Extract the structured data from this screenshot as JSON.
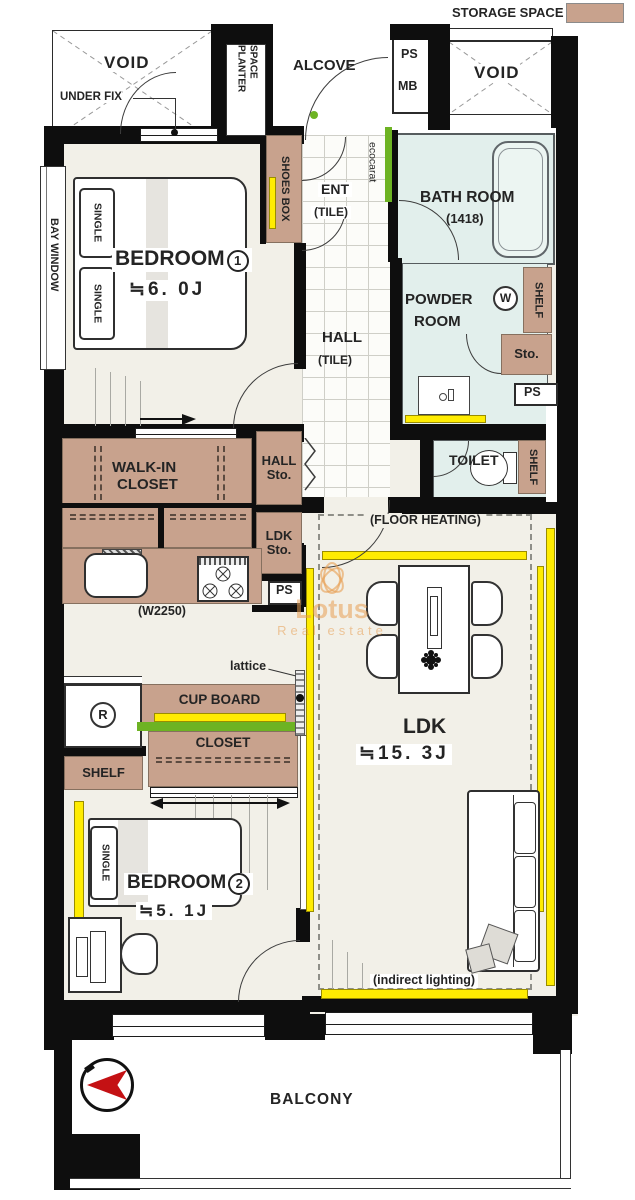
{
  "legend": {
    "storage_space": "STORAGE SPACE"
  },
  "top": {
    "void_left": "VOID",
    "under_fix": "UNDER FIX",
    "planter_1": "PLANTER",
    "planter_2": "SPACE",
    "alcove": "ALCOVE",
    "ps": "PS",
    "mb": "MB",
    "void_right": "VOID"
  },
  "entrance": {
    "shoes_box": "SHOES BOX",
    "ent": "ENT",
    "tile": "(TILE)",
    "ecocarat": "ecocarat"
  },
  "bath": {
    "name": "BATH ROOM",
    "size": "(1418)"
  },
  "powder": {
    "name_1": "POWDER",
    "name_2": "ROOM",
    "washer": "W",
    "shelf": "SHELF",
    "sto": "Sto.",
    "ps": "PS"
  },
  "toilet": {
    "name": "TOILET",
    "shelf": "SHELF"
  },
  "hall": {
    "name": "HALL",
    "tile": "(TILE)",
    "sto_1": "HALL",
    "sto_2": "Sto."
  },
  "bedroom1": {
    "name": "BEDROOM",
    "num": "1",
    "size": "≒6. 0J",
    "single": "SINGLE",
    "bay_window": "BAY WINDOW"
  },
  "wic": {
    "name_1": "WALK-IN",
    "name_2": "CLOSET"
  },
  "kitchen": {
    "width": "(W2250)",
    "ps": "PS",
    "ldk_sto_1": "LDK",
    "ldk_sto_2": "Sto.",
    "cup_board": "CUP BOARD",
    "closet": "CLOSET",
    "shelf": "SHELF",
    "fridge": "R",
    "lattice": "lattice"
  },
  "ldk": {
    "floor_heating": "(FLOOR HEATING)",
    "name": "LDK",
    "size": "≒15. 3J",
    "indirect": "(indirect lighting)"
  },
  "bedroom2": {
    "name": "BEDROOM",
    "num": "2",
    "size": "≒5. 1J",
    "single": "SINGLE"
  },
  "balcony": {
    "name": "BALCONY"
  },
  "watermark": {
    "line1": "Lotus",
    "line2": "Real estate"
  },
  "colors": {
    "wall": "#0e0e0e",
    "floor": "#f2f0e8",
    "wet_room": "#e2efec",
    "storage": "#c8a28d",
    "highlight_yellow": "#ffec02",
    "ecocarat_green": "#6db323",
    "compass_red": "#c41114",
    "watermark_orange": "#e8a45e"
  }
}
